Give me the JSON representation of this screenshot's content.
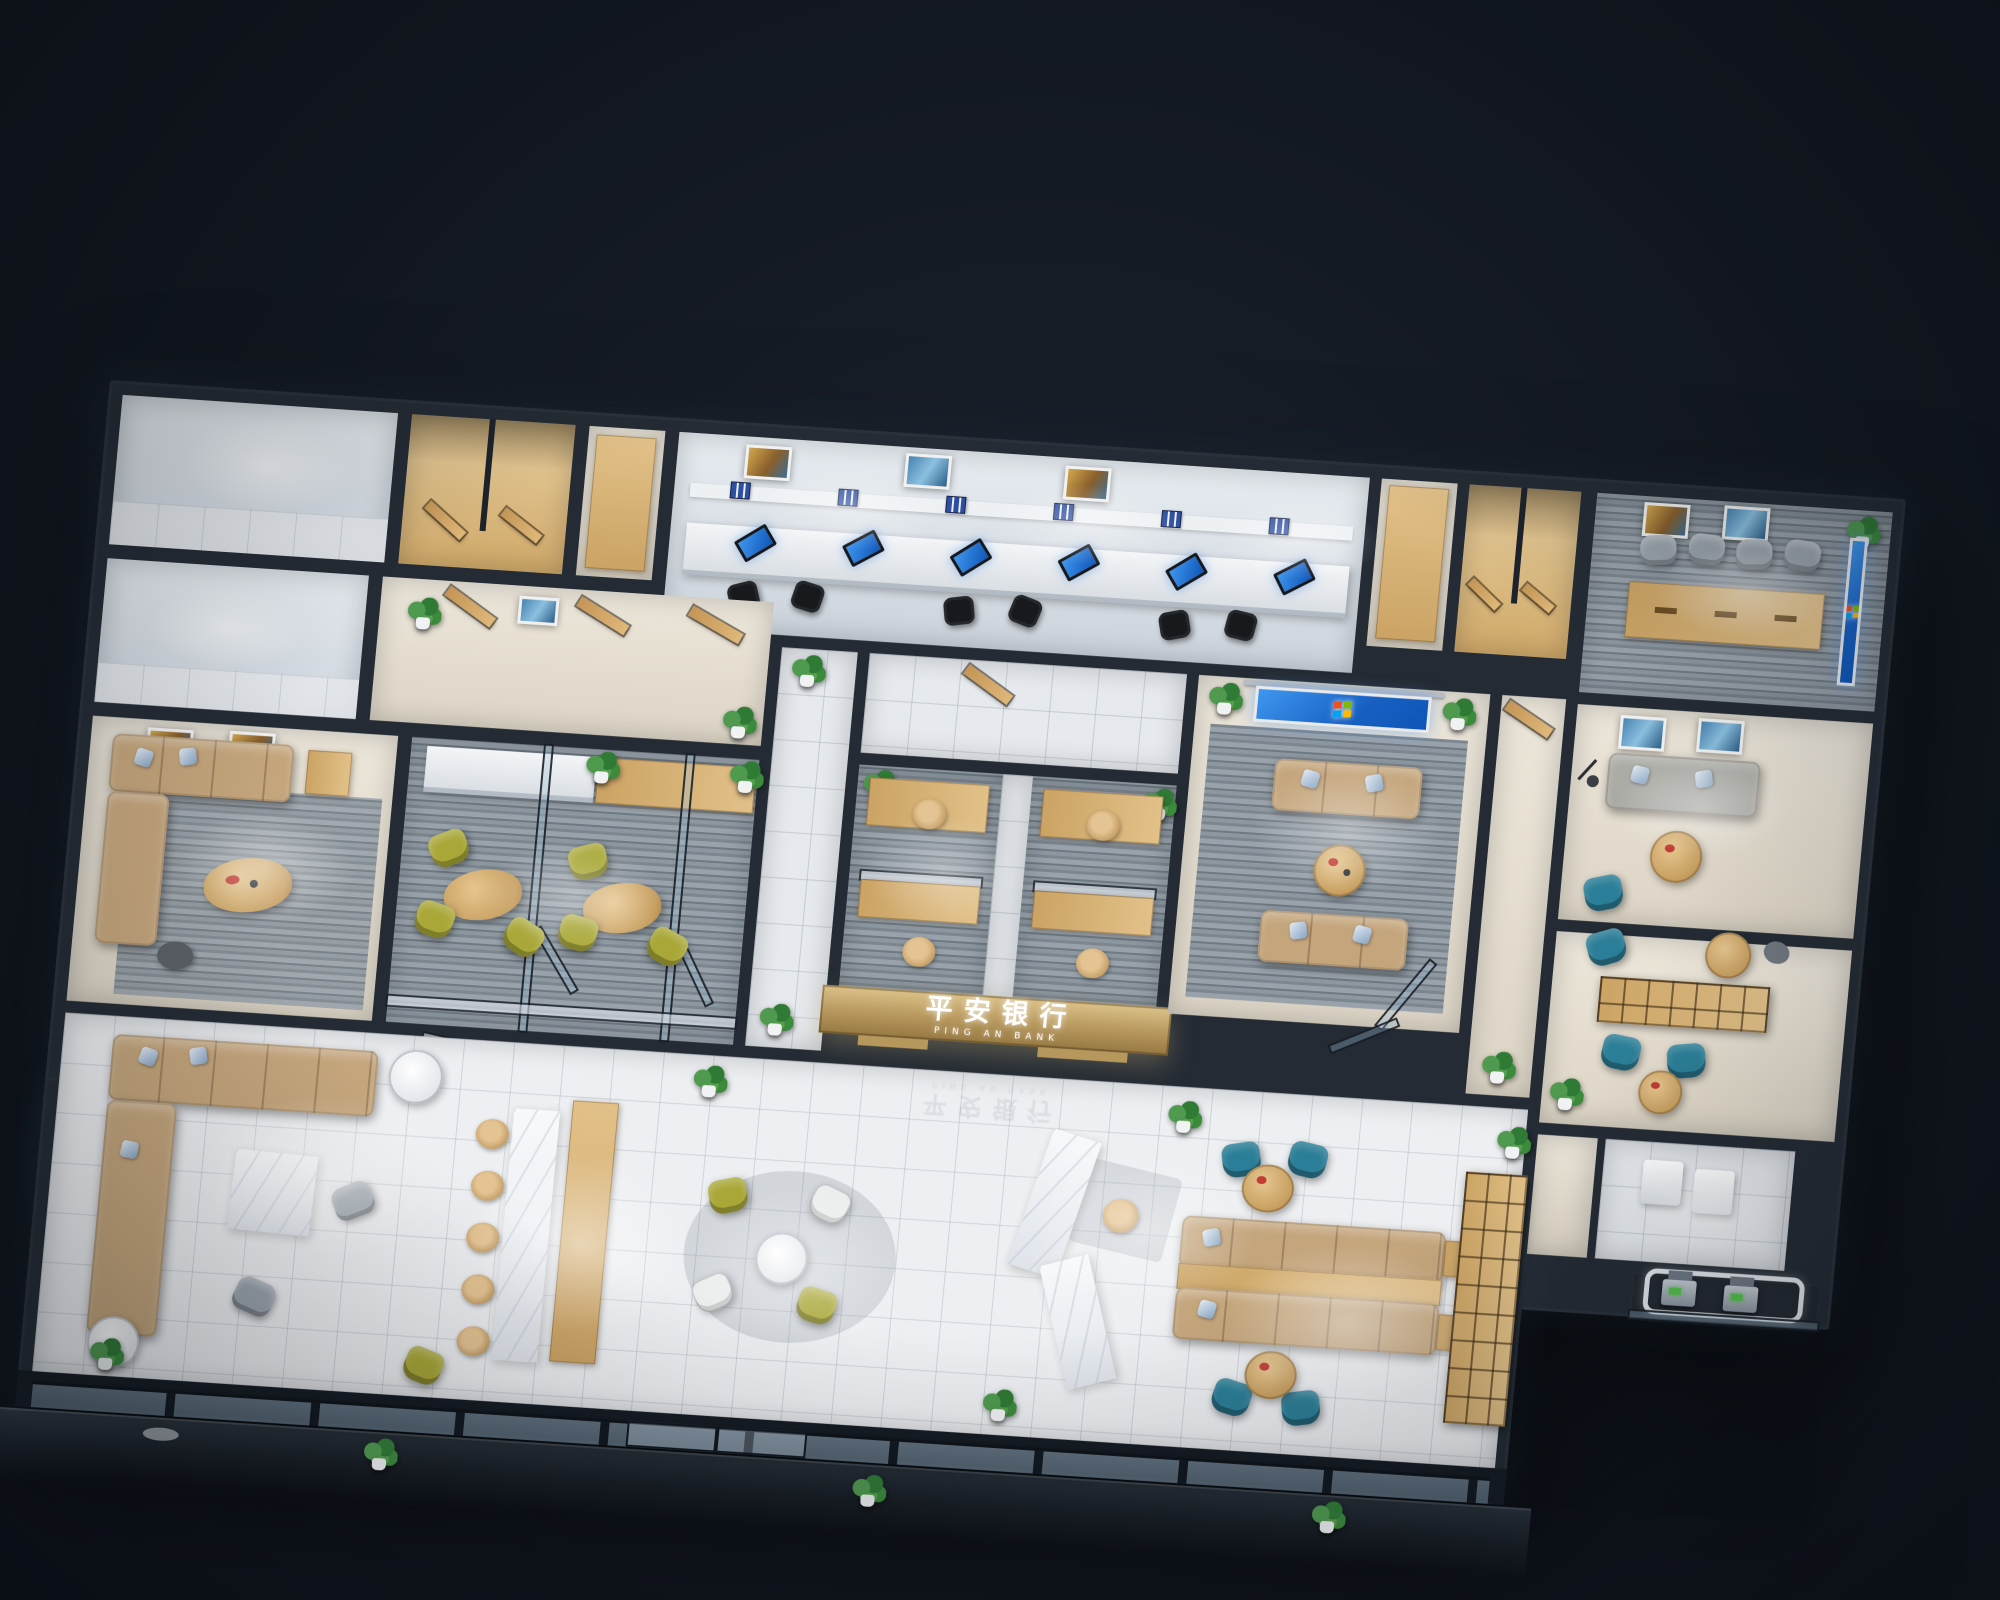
{
  "sign": {
    "cn": "平安银行",
    "en": "PING AN BANK"
  },
  "screens": {
    "wallpaper": "windows-blue"
  },
  "colors": {
    "bg_a": "#10151d",
    "bg_b": "#1b222d",
    "wall": "#242b34",
    "wall_dark": "#161c24",
    "gold": "#b6975c",
    "wood_a": "#cba364",
    "wood_b": "#e2c189",
    "tan": "#c4a57c",
    "teal": "#2b7e97",
    "olive": "#a9a737",
    "gray_chair": "#9aa3ac",
    "screen_a": "#3f97ef",
    "screen_b": "#0f55b8",
    "binder": "#2d4fa2",
    "plant": "#3f8743",
    "win_red": "#f25022",
    "win_green": "#7fba00",
    "win_blue": "#00a4ef",
    "win_yellow": "#ffb900"
  }
}
